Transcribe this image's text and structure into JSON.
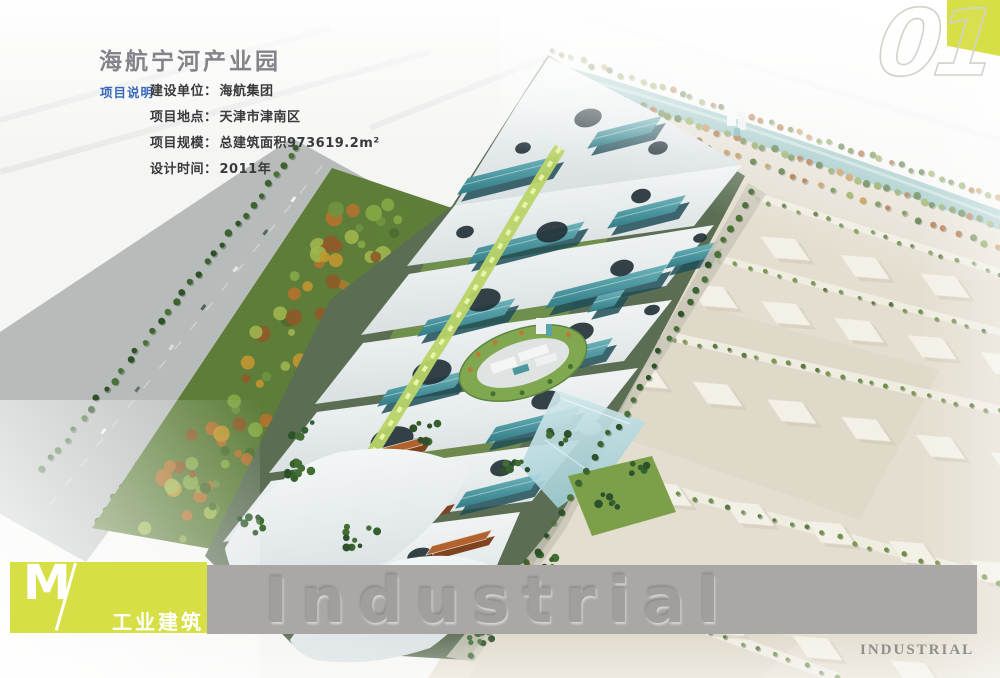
{
  "page": {
    "title": "海航宁河产业园"
  },
  "project_info": {
    "section_label": "项目说明",
    "rows": [
      {
        "label": "建设单位：",
        "value": "海航集团"
      },
      {
        "label": "项目地点：",
        "value": "天津市津南区"
      },
      {
        "label": "项目规模：",
        "value": "总建筑面积973619.2m²"
      },
      {
        "label": "设计时间：",
        "value": "2011年"
      }
    ]
  },
  "page_number": "01",
  "footer": {
    "category_letter": "M",
    "category_label": "工业建筑",
    "watermark": "Industrial",
    "corner_label": "INDUSTRIAL"
  },
  "colors": {
    "accent_yellow_green": "#d6df45",
    "info_label_blue": "#3968b8",
    "band_gray": "#a9a8a6"
  }
}
